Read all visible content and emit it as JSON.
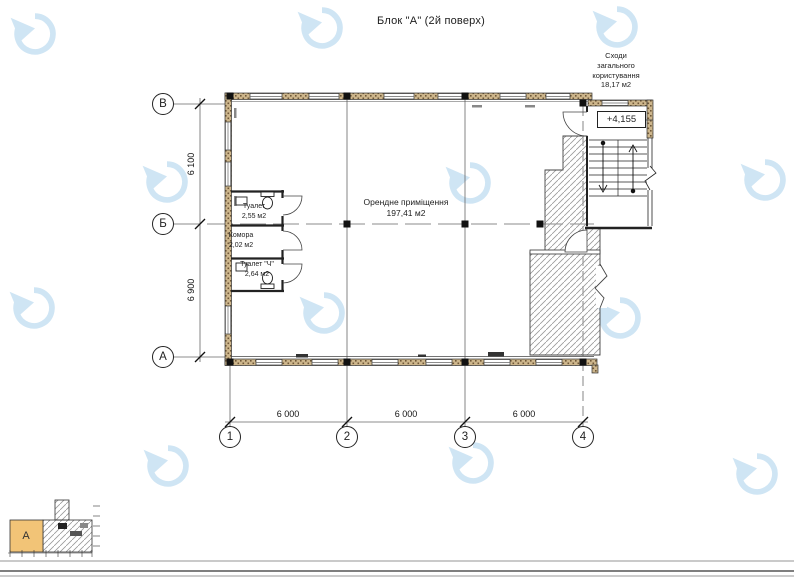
{
  "page": {
    "title": "Блок \"А\" (2й поверх)"
  },
  "stairwell": {
    "label_lines": [
      "Сходи",
      "загального",
      "користування"
    ],
    "area": "18,17 м2",
    "elevation": "+4,155"
  },
  "rooms": {
    "main": {
      "name": "Орендне приміщення",
      "area": "197,41 м2"
    },
    "toilet_top": {
      "name": "Туалет",
      "area": "2,55 м2"
    },
    "storage": {
      "name": "Комора",
      "area": "2,02 м2"
    },
    "toilet_bottom": {
      "name": "Туалет \"Ч\"",
      "area": "2,64 м2"
    }
  },
  "axes": {
    "rows": [
      "В",
      "Б",
      "А"
    ],
    "cols": [
      "1",
      "2",
      "3",
      "4"
    ]
  },
  "dimensions": {
    "vertical": [
      "6 100",
      "6 900"
    ],
    "horizontal": [
      "6 000",
      "6 000",
      "6 000"
    ]
  },
  "key_plan": {
    "block_label": "А"
  },
  "colors": {
    "wall_fill": "#cdb68c",
    "wall_speckle": "#6e5737",
    "hatch_line": "#999999",
    "watermark": "#cfe5f4",
    "key_block_fill": "#f2c477",
    "line": "#333333"
  }
}
